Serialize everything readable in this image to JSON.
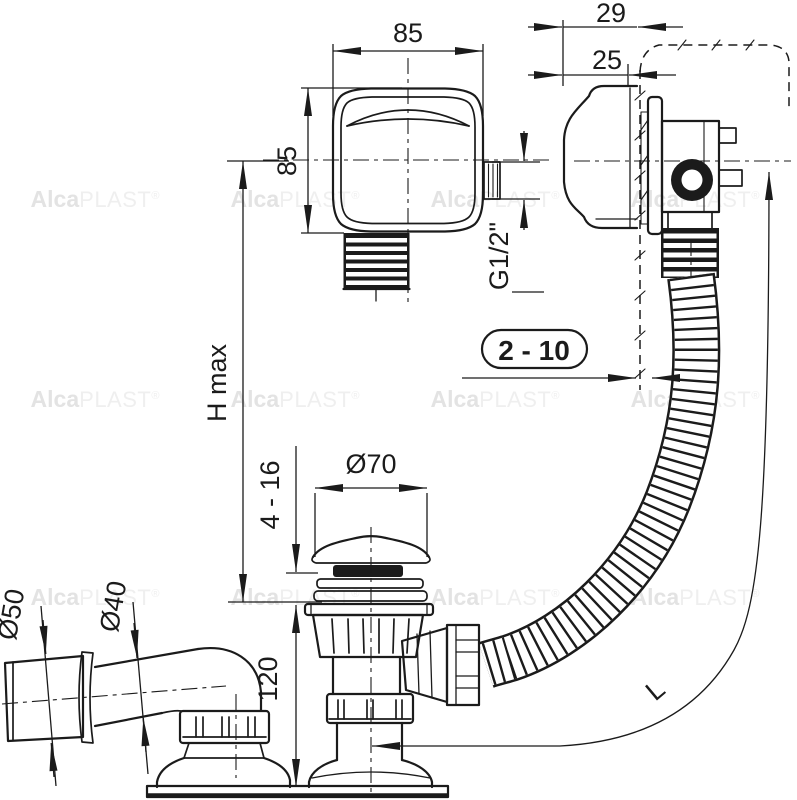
{
  "drawing": {
    "brand": {
      "alca": "Alca",
      "plast": "PLAST",
      "reg": "®"
    },
    "dimensions": {
      "knob_width": "85",
      "knob_height": "85",
      "depth_total": "29",
      "depth_front": "25",
      "thread": "G1/2\"",
      "panel_thickness": "2 - 10",
      "height_max": "H max",
      "plug_diameter": "Ø70",
      "bottom_thickness": "4 - 16",
      "outlet_socket_diameter": "Ø50",
      "outlet_pipe_diameter": "Ø40",
      "trap_height": "120",
      "hose_length": "L"
    },
    "colors": {
      "line": "#1b1b1b",
      "background": "#ffffff",
      "watermark_bold": "#e3e3e3",
      "watermark_light": "#efefef"
    }
  }
}
